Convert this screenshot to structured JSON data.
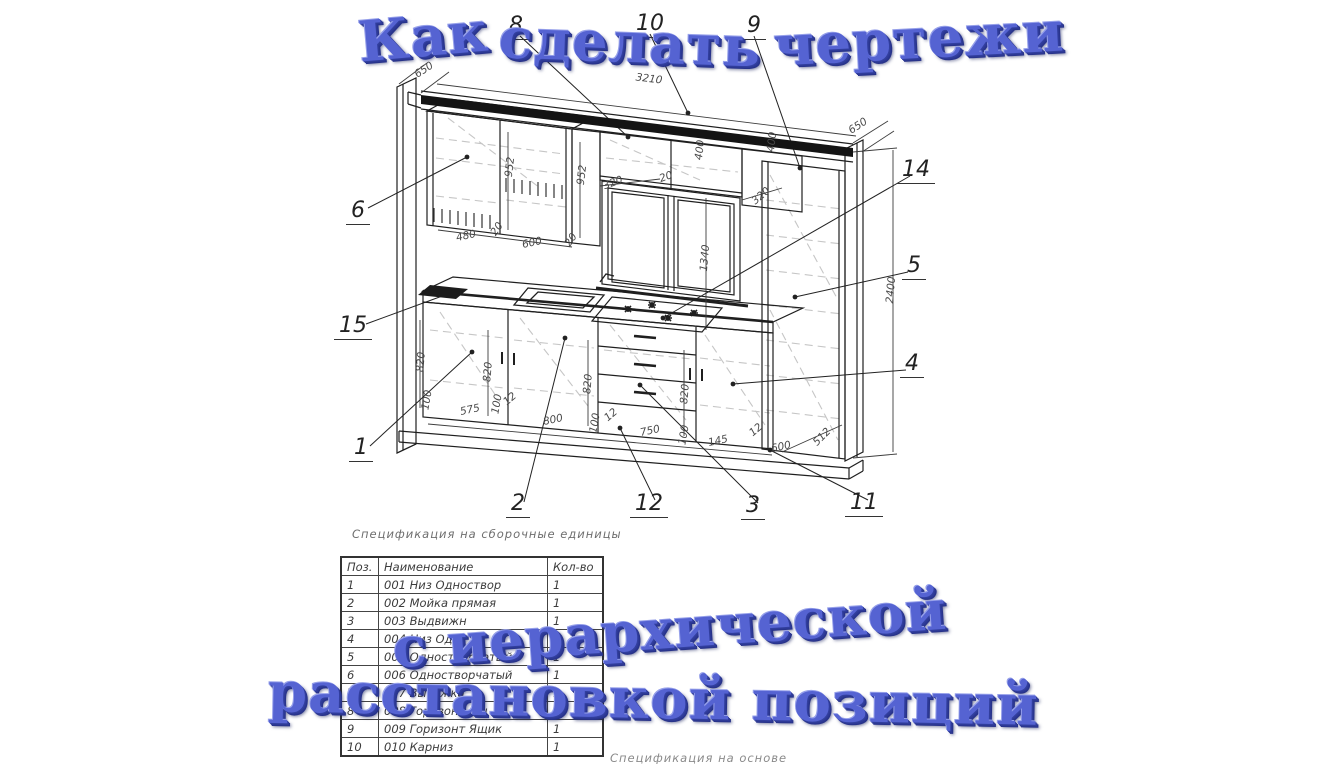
{
  "overlay": {
    "accent_color": "#5563d2",
    "title_top_words": [
      "Как",
      "сделать",
      "чертежи"
    ],
    "title_bottom_line1": "с иерархической",
    "title_bottom_line2": "расстановкой позиций"
  },
  "spec_table": {
    "caption": "Спецификация на сборочные единицы",
    "headers": [
      "Поз.",
      "Наименование",
      "Кол-во"
    ],
    "rows": [
      [
        "1",
        "001 Низ Одноствор",
        "1"
      ],
      [
        "2",
        "002 Мойка прямая",
        "1"
      ],
      [
        "3",
        "003 Выдвижн",
        "1"
      ],
      [
        "4",
        "004 Низ Одн",
        "1"
      ],
      [
        "5",
        "005 Одностворчатый",
        "1"
      ],
      [
        "6",
        "006 Одностворчатый",
        "1"
      ],
      [
        "7",
        "007 Вытяжка",
        "1"
      ],
      [
        "8",
        "008 Горизонт Ящ",
        "1"
      ],
      [
        "9",
        "009 Горизонт Ящик",
        "1"
      ],
      [
        "10",
        "010 Карниз",
        "1"
      ]
    ]
  },
  "footer_caption": "Спецификация на основе",
  "drawing": {
    "dims": [
      {
        "t": "650",
        "x": 424,
        "y": 70,
        "r": -33
      },
      {
        "t": "3210",
        "x": 649,
        "y": 79,
        "r": 7
      },
      {
        "t": "650",
        "x": 858,
        "y": 126,
        "r": -33
      },
      {
        "t": "952",
        "x": 510,
        "y": 167,
        "r": -83
      },
      {
        "t": "952",
        "x": 582,
        "y": 175,
        "r": -83
      },
      {
        "t": "400",
        "x": 700,
        "y": 150,
        "r": -83
      },
      {
        "t": "400",
        "x": 772,
        "y": 142,
        "r": -83
      },
      {
        "t": "320",
        "x": 613,
        "y": 183,
        "r": -20
      },
      {
        "t": "20",
        "x": 666,
        "y": 177,
        "r": -20
      },
      {
        "t": "320",
        "x": 761,
        "y": 196,
        "r": -40
      },
      {
        "t": "480",
        "x": 466,
        "y": 236,
        "r": -12
      },
      {
        "t": "20",
        "x": 497,
        "y": 229,
        "r": -55
      },
      {
        "t": "600",
        "x": 532,
        "y": 243,
        "r": -12
      },
      {
        "t": "20",
        "x": 571,
        "y": 240,
        "r": -55
      },
      {
        "t": "820",
        "x": 421,
        "y": 362,
        "r": -85
      },
      {
        "t": "820",
        "x": 488,
        "y": 372,
        "r": -85
      },
      {
        "t": "820",
        "x": 588,
        "y": 384,
        "r": -85
      },
      {
        "t": "820",
        "x": 685,
        "y": 394,
        "r": -85
      },
      {
        "t": "100",
        "x": 427,
        "y": 400,
        "r": -80
      },
      {
        "t": "575",
        "x": 470,
        "y": 410,
        "r": -12
      },
      {
        "t": "100",
        "x": 497,
        "y": 404,
        "r": -80
      },
      {
        "t": "12",
        "x": 510,
        "y": 399,
        "r": -40
      },
      {
        "t": "800",
        "x": 553,
        "y": 420,
        "r": -12
      },
      {
        "t": "100",
        "x": 595,
        "y": 423,
        "r": -80
      },
      {
        "t": "12",
        "x": 611,
        "y": 415,
        "r": -40
      },
      {
        "t": "750",
        "x": 650,
        "y": 431,
        "r": -12
      },
      {
        "t": "100",
        "x": 684,
        "y": 435,
        "r": -80
      },
      {
        "t": "12",
        "x": 756,
        "y": 430,
        "r": -40
      },
      {
        "t": "145",
        "x": 718,
        "y": 441,
        "r": -12
      },
      {
        "t": "600",
        "x": 781,
        "y": 447,
        "r": -12
      },
      {
        "t": "512",
        "x": 822,
        "y": 437,
        "r": -45
      },
      {
        "t": "2400",
        "x": 891,
        "y": 290,
        "r": -85
      },
      {
        "t": "1340",
        "x": 705,
        "y": 258,
        "r": -85
      }
    ],
    "callouts": [
      {
        "n": "8",
        "x": 516,
        "y": 40
      },
      {
        "n": "10",
        "x": 650,
        "y": 38
      },
      {
        "n": "9",
        "x": 754,
        "y": 40
      },
      {
        "n": "6",
        "x": 358,
        "y": 225
      },
      {
        "n": "15",
        "x": 353,
        "y": 340
      },
      {
        "n": "1",
        "x": 361,
        "y": 462
      },
      {
        "n": "2",
        "x": 518,
        "y": 518
      },
      {
        "n": "12",
        "x": 649,
        "y": 518
      },
      {
        "n": "3",
        "x": 753,
        "y": 520
      },
      {
        "n": "11",
        "x": 864,
        "y": 517
      },
      {
        "n": "4",
        "x": 912,
        "y": 378
      },
      {
        "n": "5",
        "x": 914,
        "y": 280
      },
      {
        "n": "14",
        "x": 916,
        "y": 184
      }
    ]
  }
}
